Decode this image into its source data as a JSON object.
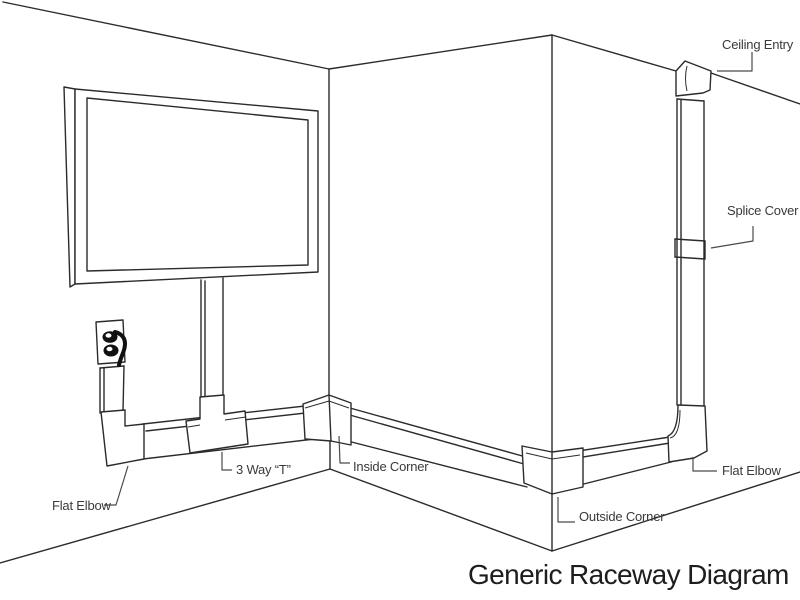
{
  "title": "Generic Raceway Diagram",
  "labels": {
    "ceiling_entry": "Ceiling Entry",
    "splice_cover": "Splice Cover",
    "flat_elbow_right": "Flat Elbow",
    "outside_corner": "Outside Corner",
    "inside_corner": "Inside Corner",
    "three_way_t": "3 Way “T”",
    "flat_elbow_left": "Flat Elbow"
  },
  "colors": {
    "background": "#ffffff",
    "line": "#2b2b2b",
    "leader": "#4a4a4a",
    "label_text": "#3a3a3a",
    "title_text": "#1d1d1d",
    "outlet_fill": "#111111"
  }
}
